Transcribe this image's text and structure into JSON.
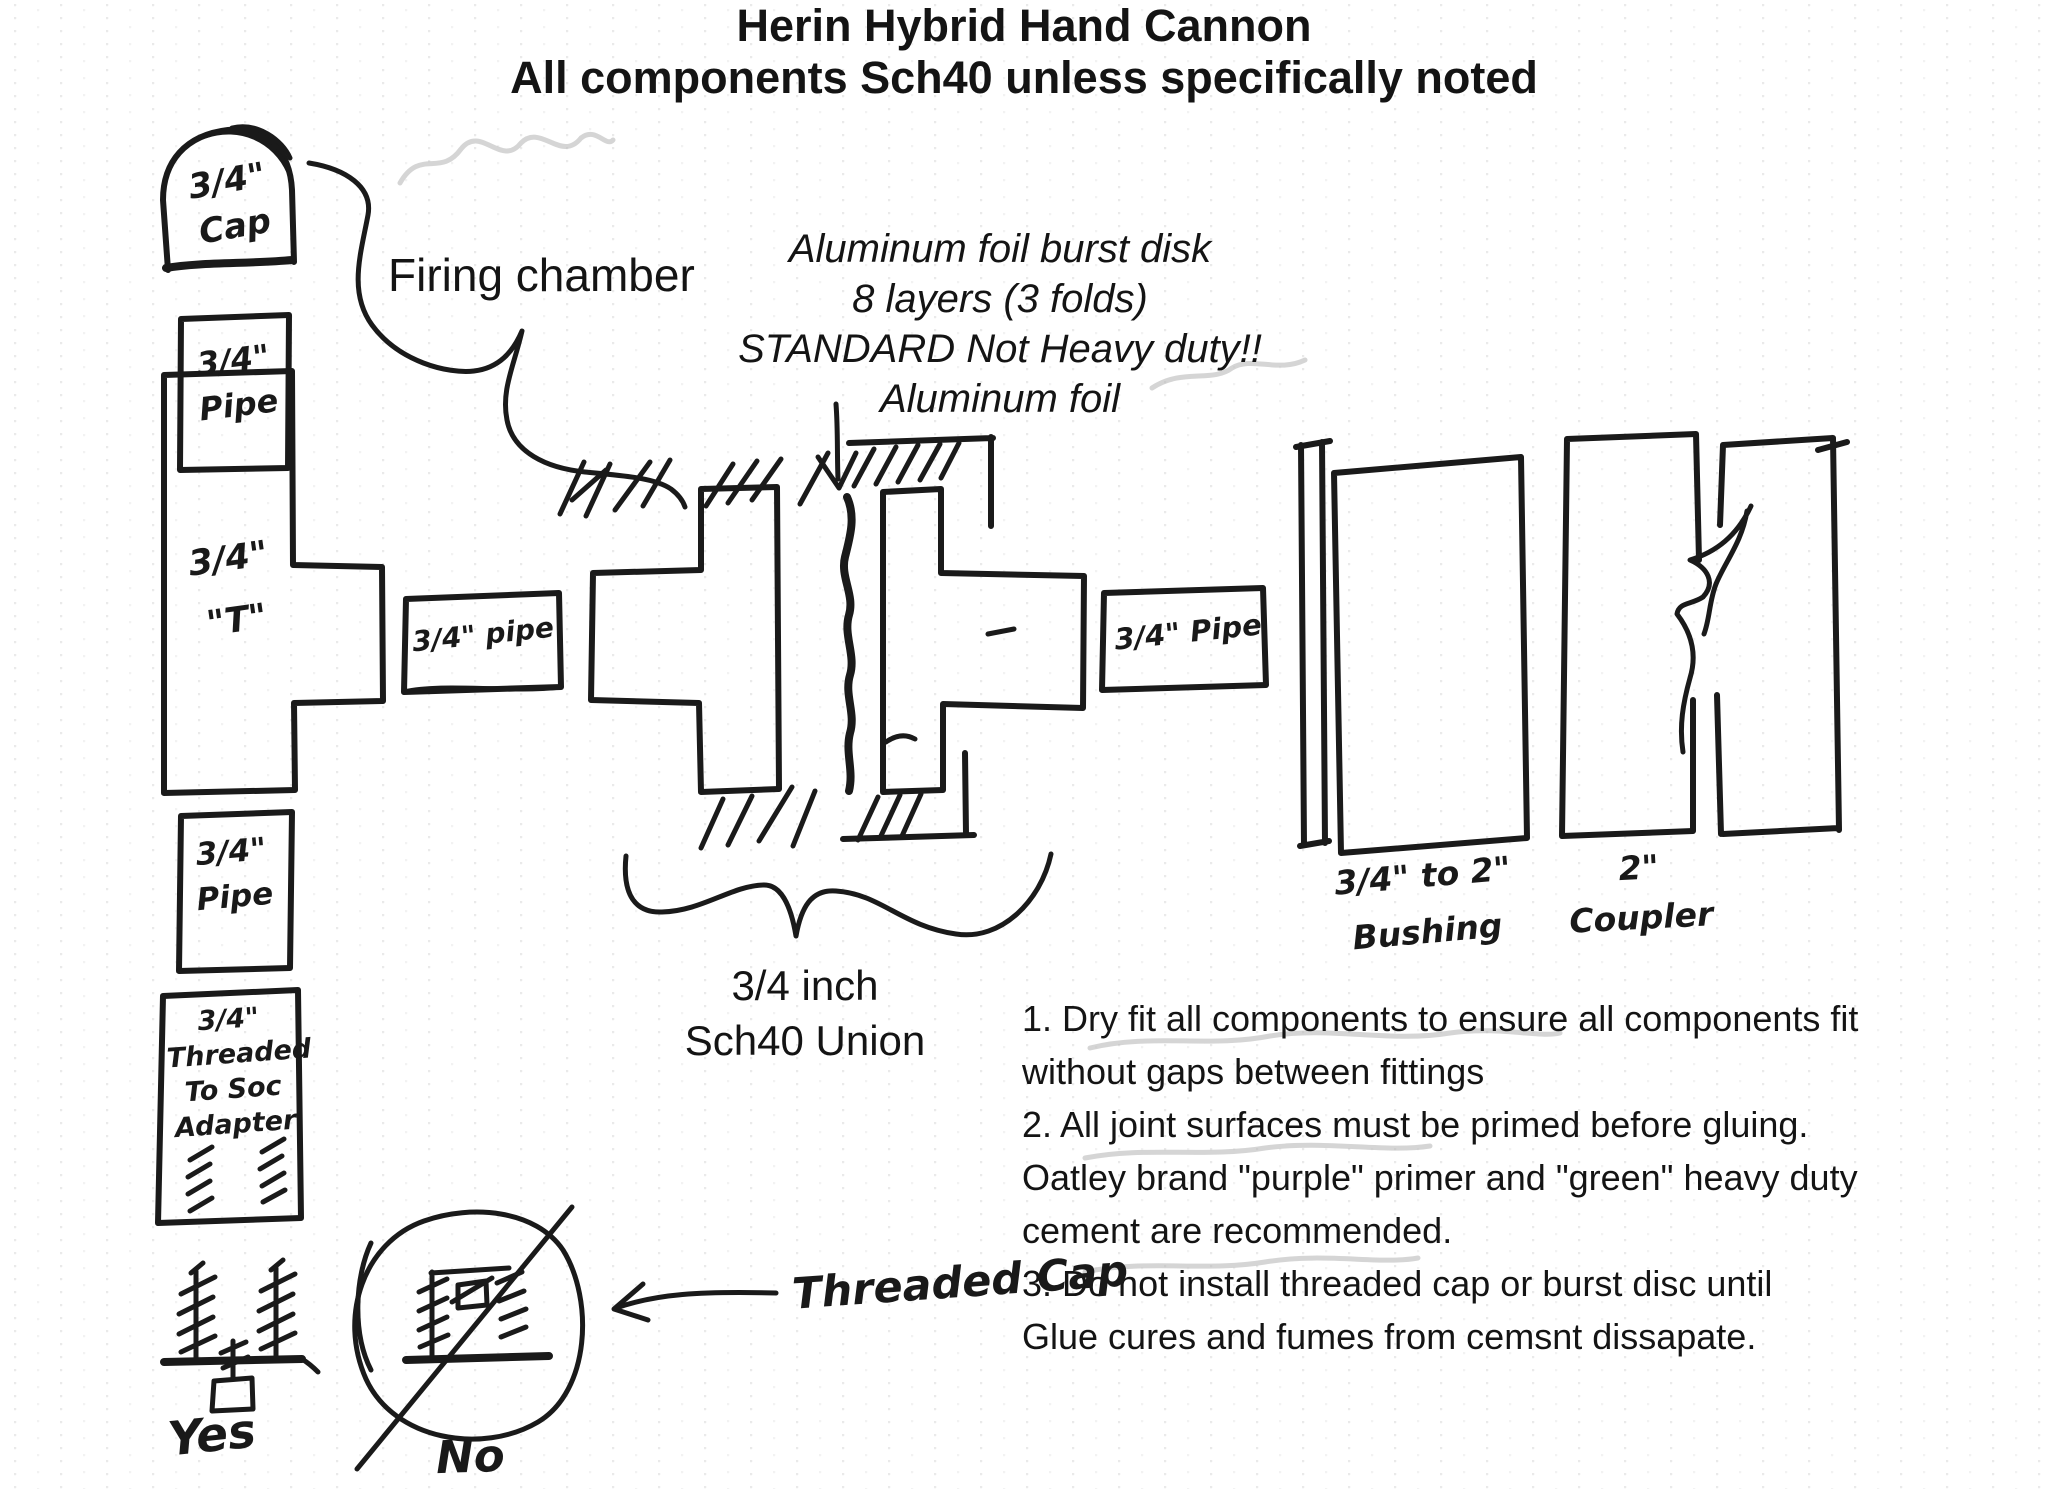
{
  "title": {
    "line1": "Herin Hybrid Hand Cannon",
    "line2": "All components Sch40 unless specifically noted"
  },
  "labels": {
    "firing_chamber": "Firing chamber",
    "burst_disk_lines": [
      "Aluminum foil burst disk",
      "8 layers (3 folds)",
      "STANDARD Not Heavy duty!!",
      "Aluminum foil"
    ],
    "union_lines": [
      "3/4 inch",
      "Sch40 Union"
    ],
    "threaded_cap": "Threaded Cap",
    "yes": "Yes",
    "no": "No"
  },
  "components": {
    "cap": {
      "lines": [
        "3/4\"",
        "Cap"
      ]
    },
    "pipe_top": {
      "lines": [
        "3/4\"",
        "Pipe"
      ]
    },
    "tee": {
      "lines": [
        "3/4\"",
        "\"T\""
      ]
    },
    "pipe_mid": {
      "lines": [
        "3/4\" pipe"
      ]
    },
    "pipe_right": {
      "lines": [
        "3/4\" Pipe"
      ]
    },
    "pipe_lower": {
      "lines": [
        "3/4\"",
        "Pipe"
      ]
    },
    "adapter": {
      "lines": [
        "3/4\"",
        "Threaded",
        "To Soc",
        "Adapter"
      ]
    },
    "bushing": {
      "lines": [
        "3/4\" to 2\"",
        "Bushing"
      ]
    },
    "coupler": {
      "lines": [
        "2\"",
        "Coupler"
      ]
    }
  },
  "instructions": [
    "1. Dry fit all components to ensure all components fit",
    "without gaps between fittings",
    "2. All joint surfaces must be primed before gluing.",
    "Oatley brand \"purple\" primer and \"green\" heavy duty",
    "cement are recommended.",
    "3. Do not install threaded cap or burst disc until",
    "Glue cures and fumes from cemsnt dissapate."
  ],
  "colors": {
    "ink": "#1a1a1a",
    "pencil_ghost": "#b9b9b9",
    "paper": "#ffffff"
  }
}
